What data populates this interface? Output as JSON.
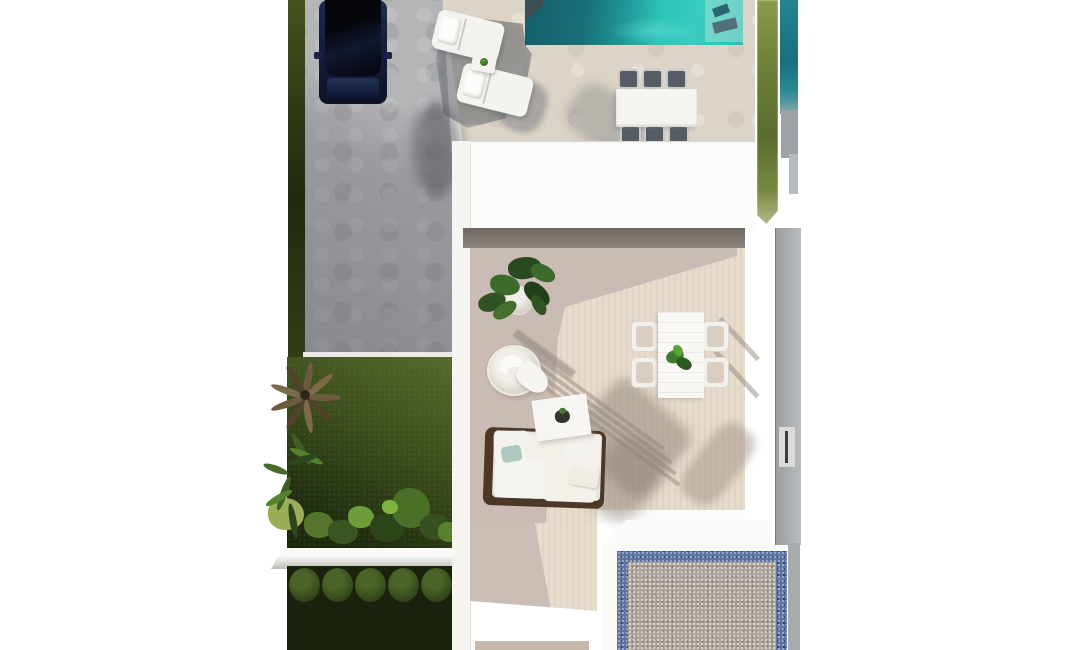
{
  "scene": {
    "type": "aerial-3d-architectural-render",
    "description": "Top-down 3D render of a villa plot: driveway with parked car, lawn strips, swimming pool with sun loungers and outdoor dining set, white flat-roofed house, tiled terrace with dining set, hanging egg chair, coffee table and sofa, garden with palm and hedge topiary, and a blue-bordered gravel patio",
    "objects": [
      "parked-car",
      "driveway-pavers",
      "grass-strip-left",
      "swimming-pool",
      "pool-steps",
      "sun-lounger",
      "sun-lounger",
      "side-table-with-plant",
      "pool-dining-table",
      "pool-dining-chairs",
      "house-roof",
      "terrace",
      "potted-plant",
      "hanging-egg-chair",
      "coffee-table",
      "outdoor-sofa",
      "terrace-dining-table",
      "terrace-dining-chairs",
      "lawn",
      "palm-tree",
      "shrub-row",
      "garden-ledge",
      "topiary-hedge-row",
      "gravel-patio",
      "neighbor-pool-strip",
      "grass-strip-right",
      "boundary-wall"
    ]
  },
  "colors": {
    "page_bg": "#ffffff",
    "grass_strip": "#46531f",
    "grass_right": "#5a6c2e",
    "lawn_light": "#57682b",
    "lawn_dark": "#202c10",
    "pavement": "#b4b5b7",
    "car_body": "#16203f",
    "car_glass": "#070a14",
    "car_hood": "#1d2c52",
    "deck": "#dcd4c6",
    "pool_deep": "#155f6d",
    "pool_mid": "#1f9697",
    "pool_bright": "#2fc5ba",
    "pool_steps": "rgba(205,238,232,0.38)",
    "roof_white": "#fcfcfb",
    "wall_white": "#f6f5f2",
    "terrace_sun": "#e7dbcb",
    "terrace_shadow": "#c8bbb3",
    "terrace_band_dark": "#6f6963",
    "wood_brown": "#4c3826",
    "pillow_teal": "#aec8bf",
    "chair_dark": "#555c63",
    "hedge_base": "#18220c",
    "hedge_ball": "#4a6326",
    "ledge_white": "#fafaf8",
    "gravel_blue": "#5d74a0",
    "gravel_warm": "#b1a69d",
    "frame_white": "#fafaf9",
    "side_wall_gray": "#9b9fa2",
    "neighbor_teal": "#23858f",
    "plant_green_dark": "#2f5323",
    "plant_green_mid": "#3c6a2b",
    "plant_green_light": "#456f2e",
    "palm_brown": "#6d5b40"
  }
}
